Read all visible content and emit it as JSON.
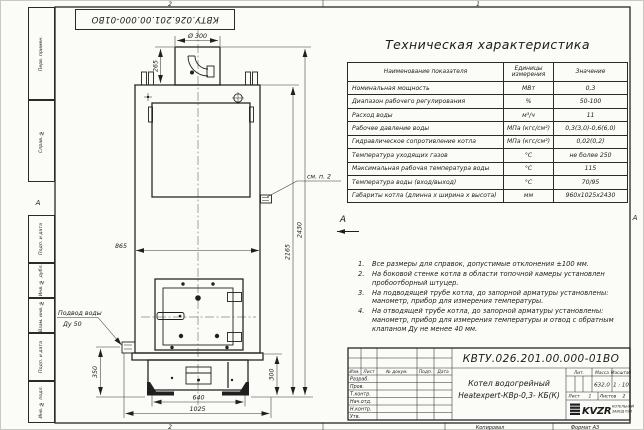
{
  "frame": {
    "doc_number_top": "КВТУ.026.201.00.000-01ВО",
    "zones": {
      "top_left": "2",
      "top_right": "1",
      "bottom_left": "2",
      "bottom_right": "1",
      "left": "А",
      "right": "А"
    },
    "rail": [
      "Перв. примен.",
      "Справ. №",
      "Подп. и дата",
      "Инв. № дубл.",
      "Взам. инв. №",
      "Подп. и дата",
      "Инв. № подл."
    ]
  },
  "drawing": {
    "view_top": "Б",
    "view_side": "А",
    "see_note": "см. п. 2",
    "water_line1": "Подвод воды",
    "water_line2": "Ду 50",
    "dims": {
      "dia": "Ø 300",
      "h_chimney": "265",
      "w_body": "865",
      "h_body": "2165",
      "h_total": "2430",
      "h_left": "350",
      "h_base": "300",
      "w_base": "640",
      "w_overall": "1025"
    }
  },
  "spec_table": {
    "title": "Техническая характеристика",
    "headers": {
      "name": "Наименование показателя",
      "unit": "Единицы измерения",
      "value": "Значение"
    },
    "rows": [
      {
        "name": "Номинальная мощность",
        "unit": "МВт",
        "value": "0,3"
      },
      {
        "name": "Диапазон рабочего регулирования",
        "unit": "%",
        "value": "50-100"
      },
      {
        "name": "Расход воды",
        "unit": "м³/ч",
        "value": "11"
      },
      {
        "name": "Рабочее давление воды",
        "unit": "МПа (кгс/см²)",
        "value": "0,3(3,0)-0,6(6,0)"
      },
      {
        "name": "Гидравлическое сопротивление котла",
        "unit": "МПа (кгс/см²)",
        "value": "0,02(0,2)"
      },
      {
        "name": "Температура уходящих газов",
        "unit": "°С",
        "value": "не более 250"
      },
      {
        "name": "Максимальная рабочая температура воды",
        "unit": "°С",
        "value": "115"
      },
      {
        "name": "Температура воды (вход/выход)",
        "unit": "°С",
        "value": "70/95"
      },
      {
        "name": "Габариты котла (длинна х ширина х высота)",
        "unit": "мм",
        "value": "960х1025х2430"
      }
    ]
  },
  "notes": {
    "items": [
      {
        "num": "1.",
        "text": "Все размеры для справок, допустимые отклонения ±100 мм."
      },
      {
        "num": "2.",
        "text": "На боковой стенке котла в области топочной камеры установлен пробоотборный штуцер."
      },
      {
        "num": "3.",
        "text": "На подводящей трубе котла, до запорной арматуры установлены: манометр, прибор для измерения температуры."
      },
      {
        "num": "4.",
        "text": "На отводящей трубе котла, до запорной арматуры установлены: манометр, прибор для измерения температуры и отвод с обратным клапаном Ду не менее 40 мм."
      }
    ]
  },
  "title_block": {
    "doc_number": "КВТУ.026.201.00.000-01ВО",
    "name_line1": "Котел водогрейный",
    "name_line2": "Heatexpert-КВр-0,3- КБ(К)",
    "cols": [
      "Изм.",
      "Лист",
      "№ докум.",
      "Подп.",
      "Дата"
    ],
    "rows": [
      "Разраб.",
      "Пров.",
      "Т.контр.",
      "Нач.отд.",
      "Н.контр.",
      "Утв."
    ],
    "lit_label": "Лит.",
    "mass_label": "Масса",
    "mass_value": "632,0",
    "scale_label": "Масштаб",
    "scale_value": "1 : 10",
    "sheet_label": "Лист",
    "sheet_value": "1",
    "sheets_label": "Листов",
    "sheets_value": "2",
    "logo_text": "KVZR",
    "logo_cap1": "КОТЕЛЬНЫЙ",
    "logo_cap2": "ЗАВОД РЭП"
  },
  "footer": {
    "copy": "Копировал",
    "format": "Формат А3"
  }
}
